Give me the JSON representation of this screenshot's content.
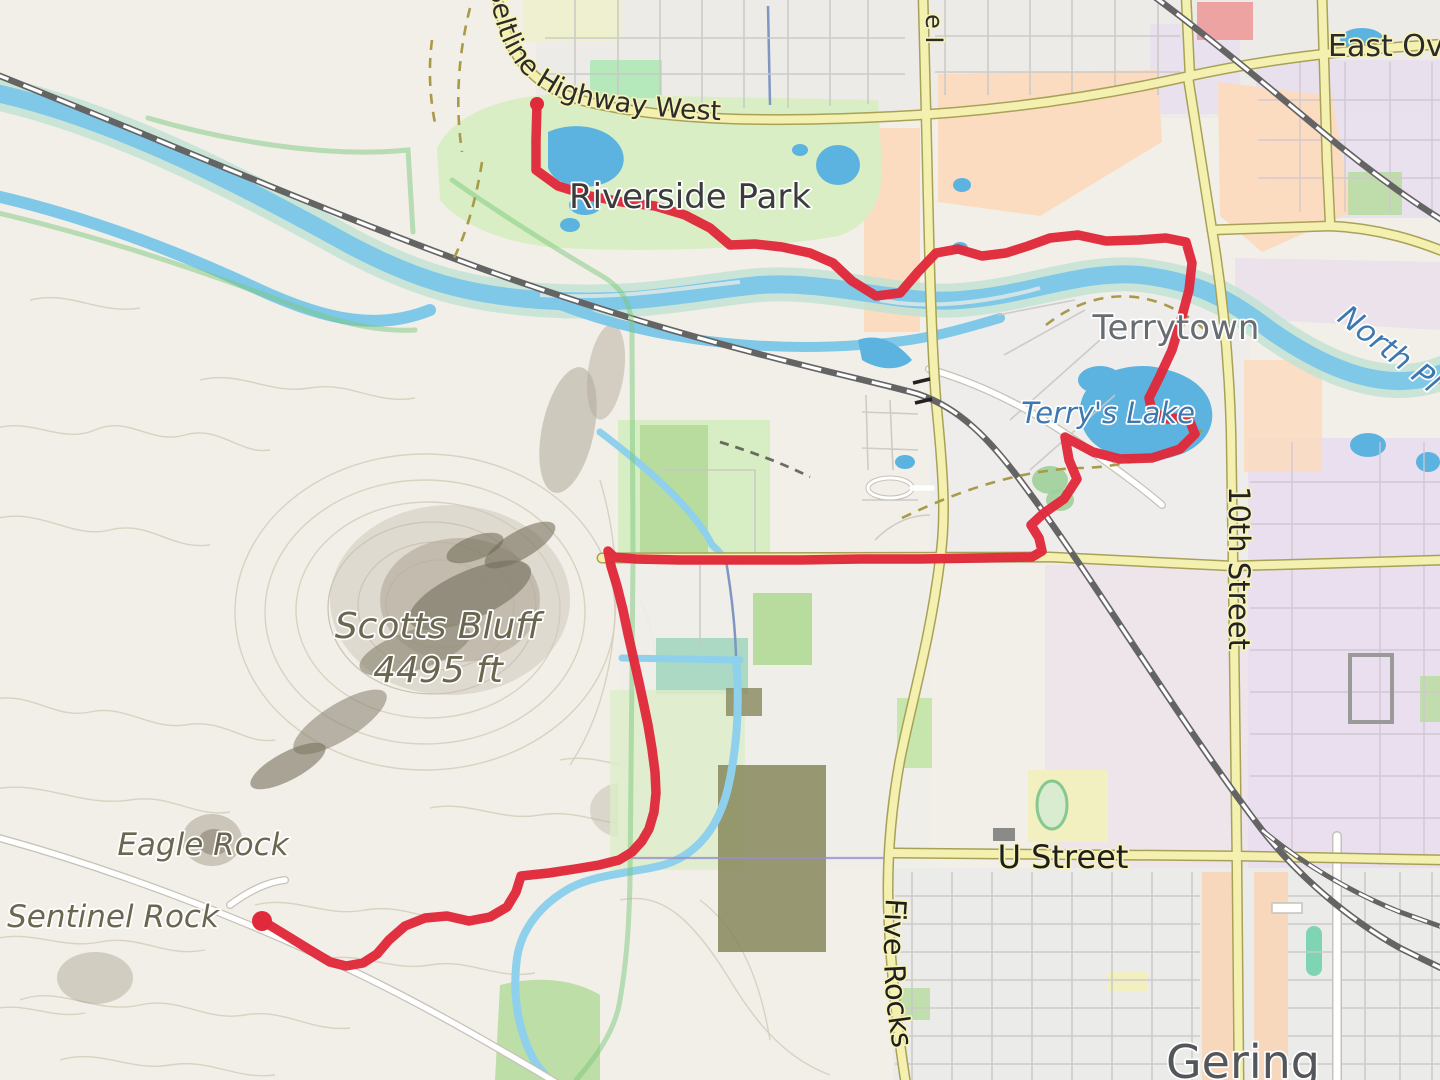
{
  "labels": {
    "highway": "Beltline Highway West",
    "east_overland_fragment": "East Ov",
    "park": "Riverside Park",
    "town": "Terrytown",
    "river_fragment": "North Pl",
    "lake": "Terry's Lake",
    "street_10th": "10th Street",
    "peak_name": "Scotts Bluff",
    "peak_elevation": "4495 ft",
    "eagle_rock": "Eagle Rock",
    "sentinel_rock": "Sentinel Rock",
    "u_street": "U Street",
    "five_rocks": "Five Rocks",
    "city": "Gering",
    "avenue_fragment": "e I"
  },
  "route": {
    "color": "#e0293a",
    "width": 9.5,
    "start": [
      537,
      104
    ],
    "start_radius": 7,
    "end": [
      262,
      921
    ],
    "end_radius": 10,
    "points": [
      [
        537,
        104
      ],
      [
        536,
        140
      ],
      [
        536,
        170
      ],
      [
        558,
        186
      ],
      [
        590,
        196
      ],
      [
        622,
        202
      ],
      [
        655,
        206
      ],
      [
        685,
        215
      ],
      [
        710,
        228
      ],
      [
        730,
        245
      ],
      [
        755,
        244
      ],
      [
        782,
        247
      ],
      [
        810,
        253
      ],
      [
        833,
        263
      ],
      [
        852,
        281
      ],
      [
        876,
        296
      ],
      [
        900,
        293
      ],
      [
        918,
        272
      ],
      [
        936,
        253
      ],
      [
        958,
        249
      ],
      [
        982,
        256
      ],
      [
        1006,
        253
      ],
      [
        1028,
        246
      ],
      [
        1050,
        238
      ],
      [
        1078,
        235
      ],
      [
        1106,
        241
      ],
      [
        1138,
        240
      ],
      [
        1166,
        238
      ],
      [
        1186,
        242
      ],
      [
        1192,
        263
      ],
      [
        1189,
        290
      ],
      [
        1181,
        320
      ],
      [
        1172,
        350
      ],
      [
        1159,
        378
      ],
      [
        1149,
        398
      ],
      [
        1152,
        412
      ],
      [
        1168,
        419
      ],
      [
        1188,
        417
      ],
      [
        1195,
        434
      ],
      [
        1180,
        449
      ],
      [
        1152,
        458
      ],
      [
        1120,
        459
      ],
      [
        1093,
        452
      ],
      [
        1065,
        437
      ],
      [
        1069,
        460
      ],
      [
        1077,
        479
      ],
      [
        1064,
        499
      ],
      [
        1044,
        513
      ],
      [
        1031,
        525
      ],
      [
        1039,
        538
      ],
      [
        1042,
        551
      ],
      [
        1032,
        557
      ],
      [
        980,
        558
      ],
      [
        920,
        559
      ],
      [
        860,
        559
      ],
      [
        800,
        560
      ],
      [
        740,
        560
      ],
      [
        680,
        560
      ],
      [
        636,
        559
      ],
      [
        614,
        557
      ],
      [
        608,
        551
      ],
      [
        611,
        566
      ],
      [
        617,
        586
      ],
      [
        623,
        610
      ],
      [
        628,
        634
      ],
      [
        633,
        656
      ],
      [
        638,
        678
      ],
      [
        643,
        701
      ],
      [
        648,
        725
      ],
      [
        652,
        749
      ],
      [
        655,
        772
      ],
      [
        656,
        793
      ],
      [
        654,
        812
      ],
      [
        649,
        829
      ],
      [
        642,
        841
      ],
      [
        632,
        852
      ],
      [
        619,
        860
      ],
      [
        599,
        865
      ],
      [
        575,
        869
      ],
      [
        549,
        873
      ],
      [
        521,
        876
      ],
      [
        516,
        892
      ],
      [
        507,
        907
      ],
      [
        490,
        917
      ],
      [
        469,
        921
      ],
      [
        447,
        916
      ],
      [
        425,
        918
      ],
      [
        405,
        926
      ],
      [
        389,
        940
      ],
      [
        377,
        954
      ],
      [
        363,
        963
      ],
      [
        346,
        966
      ],
      [
        330,
        962
      ],
      [
        310,
        950
      ],
      [
        289,
        937
      ],
      [
        271,
        926
      ],
      [
        262,
        921
      ]
    ]
  },
  "colors": {
    "bg": "#f2efe8",
    "route": "#e0293a",
    "water": "#7fc8e8",
    "water_deep": "#5cb3e0",
    "stream": "#8fd0ec",
    "ditch": "#8096c2",
    "park": "#d9eec4",
    "park_bright": "#b5e8ba",
    "wood_green": "#b7dc9e",
    "riparian": "#bfe2d2",
    "olive_patch": "#87875c",
    "peach": "#fbdcc1",
    "salmon_building": "#eca3a1",
    "lavender": "#e9dfee",
    "pink_lavender": "#ece3ea",
    "urban_gray": "#ecebe8",
    "road_yellow": "#f4f0af",
    "road_casing": "#a9a158",
    "road_white": "#ffffff",
    "white_casing": "#c6c2b8",
    "rail": "#646464",
    "grid_line": "#c9c8c5",
    "contour": "#d5cebd",
    "trail_green": "#7cc87c",
    "dash_tan": "#a89a48",
    "halo_yellow": "#f6f2b8",
    "label_dark": "#3b3b3b",
    "label_place": "#686d72",
    "label_city": "#53565a",
    "label_water": "#3e78b0",
    "label_peak": "#6b6650"
  }
}
